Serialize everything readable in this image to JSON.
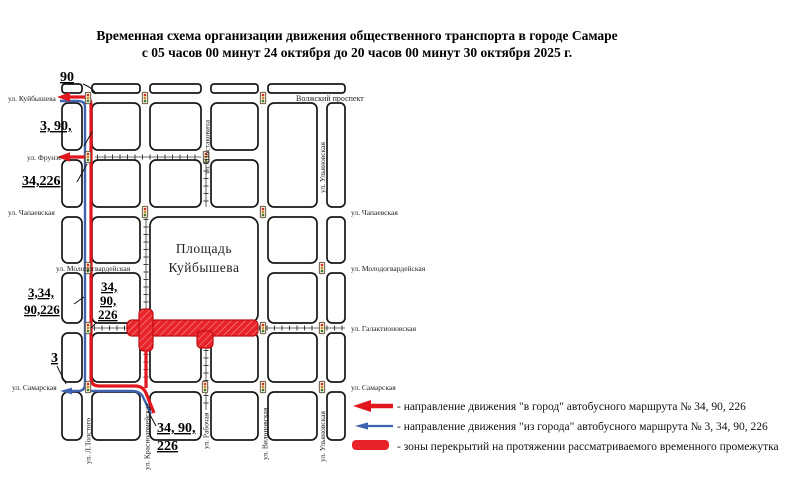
{
  "title": {
    "line1": "Временная схема организации движения общественного транспорта в городе Самаре",
    "line2": "с 05 часов 00 минут 24 октября до 20 часов 00 минут 30 октября 2025 г."
  },
  "map": {
    "square": {
      "line1": "Площадь",
      "line2": "Куйбышева"
    },
    "streets": {
      "kuybysheva": "ул. Куйбышева",
      "volzhsky": "Волжский проспект",
      "frunze": "ул. Фрунзе",
      "chapaevskaya": "ул. Чапаевская",
      "molodogvardeyskaya": "ул. Молодогвардейская",
      "galaktionovskaya": "ул. Галактионовская",
      "samarskaya": "ул. Самарская",
      "shostakovicha": "ул. Шостаковича",
      "ulyanovskaya": "ул. Ульяновская",
      "tolstogo": "ул. Л.Толстого",
      "krasnoarmeyskaya": "ул. Красноармейская",
      "rabochaya": "ул. Рабочая",
      "vilonovskaya": "ул. Вилоновская"
    },
    "route_labels": {
      "kuybysheva_in": "90",
      "out_top": "3, 90,",
      "frunze_in": "34,226",
      "out_mid_l1": "3,34,",
      "out_mid_l2": "90,226",
      "in_mid_l1": "34,",
      "in_mid_l2": "90,",
      "in_mid_l3": "226",
      "samarskaya_out": "3",
      "exit_l1": "34, 90,",
      "exit_l2": "226"
    }
  },
  "legend": {
    "in_city": "- направление движения \"в город\" автобусного маршрута № 34, 90, 226",
    "out_city": "- направление движения \"из города\" автобусного маршрута № 3, 34, 90, 226",
    "closures": "- зоны перекрытий на протяжении рассматриваемого временного промежутка"
  },
  "colors": {
    "route_in": "#e2161d",
    "route_out": "#3f63ae",
    "closure_fill": "#e8242a",
    "closure_border": "#bf0d13"
  }
}
